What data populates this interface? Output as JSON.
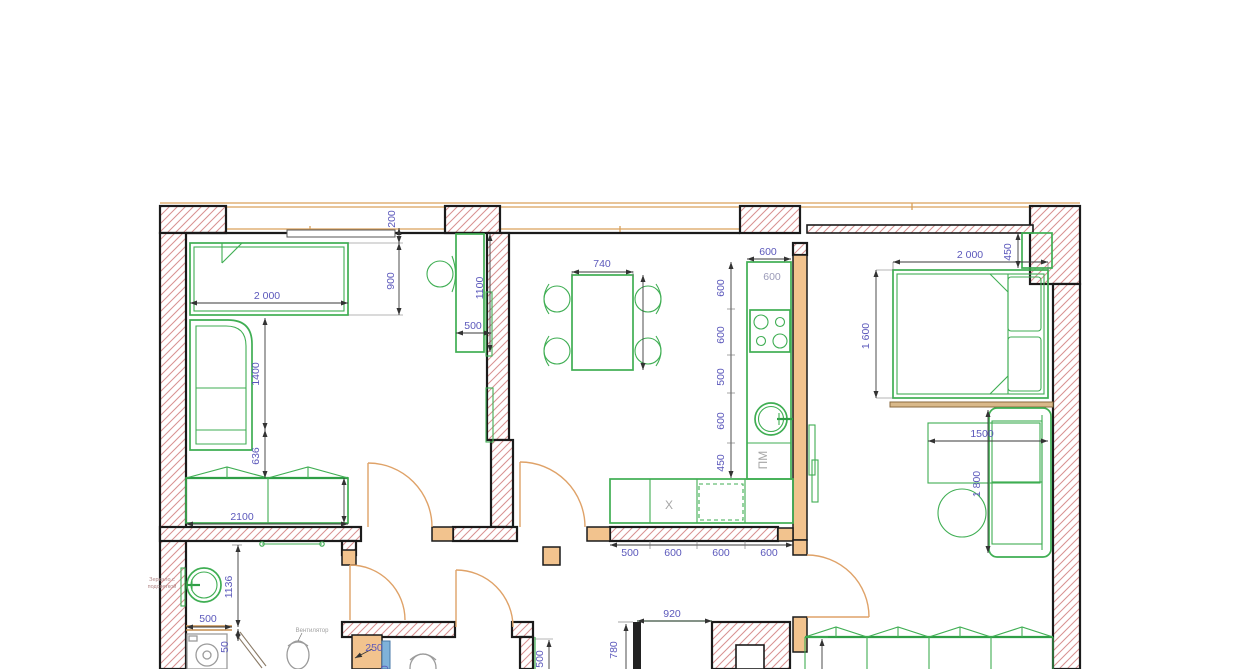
{
  "title": "apartment-floor-plan",
  "colors": {
    "furniture_green": "#3fae53",
    "dimension_blue": "#5b58bb",
    "wall_hatch_pink": "#d89090",
    "door_orange": "#dfa268",
    "jamb_fill_orange": "#f2c38e",
    "outline_black": "#1b1b1b",
    "note_gray": "#a0a0a0",
    "note_red": "#b08585",
    "appliance_blue": "#7fb2d9"
  },
  "labels": {
    "room1": {
      "win_offset": "200",
      "bed_depth": "900",
      "bed_width": "2 000",
      "sofa_len": "1400",
      "sofa_gap": "636",
      "wardrobe_width": "2100",
      "wardrobe_depth": "600",
      "desk_len": "1100",
      "desk_width": "500"
    },
    "living": {
      "table_width": "740",
      "table_length": "1 200",
      "counter_depth_top": "600",
      "counter_depth_top2": "600",
      "col": [
        "600",
        "600",
        "500",
        "600",
        "450"
      ],
      "row": [
        "500",
        "600",
        "600",
        "600"
      ],
      "dishwasher": "ПМ",
      "vent_box": "X"
    },
    "bedroom2": {
      "bed_width": "2 000",
      "nightstand": "450",
      "bed_length": "1 600",
      "desk_width": "1500",
      "sofa_length": "1 800",
      "wardrobe_depth": "600"
    },
    "hall": {
      "opening": "920",
      "depth": "780",
      "cabinet": "500"
    },
    "bathroom": {
      "washer_width": "500",
      "wall_len": "1136",
      "gap": "50",
      "washer_depth": "600",
      "mirror_note_1": "Зеркало с",
      "mirror_note_2": "подсветкой",
      "fan_note": "Вентилятор"
    },
    "wc": {
      "shaft": "250",
      "side": "600"
    }
  }
}
